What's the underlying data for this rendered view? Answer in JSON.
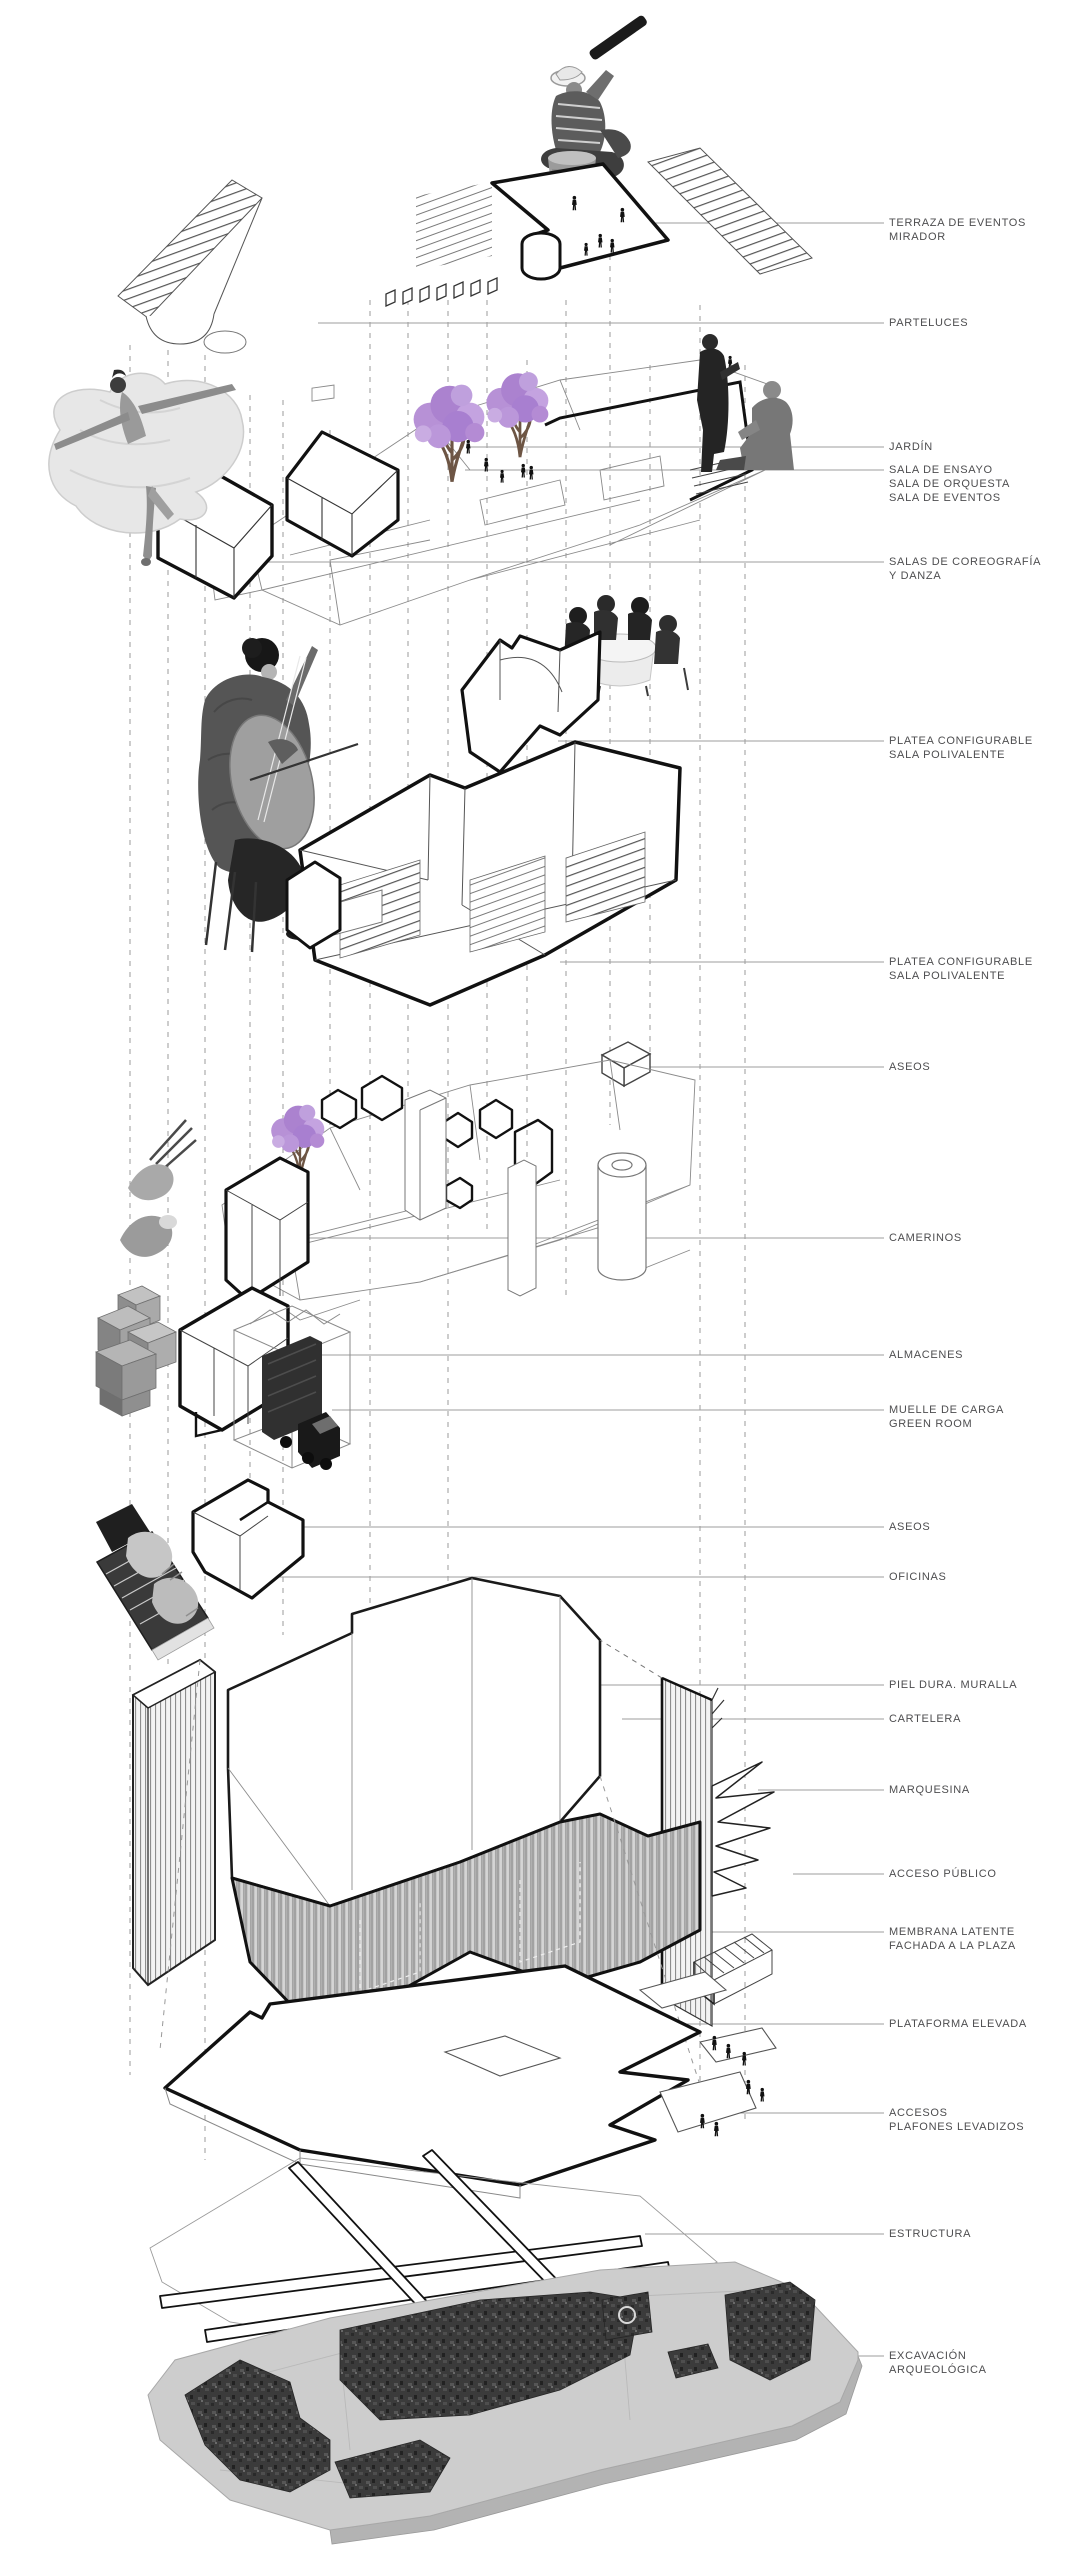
{
  "diagram": {
    "type": "exploded-axonometric-architectural-diagram",
    "language": "es"
  },
  "labels": [
    {
      "id": "terraza",
      "lines": [
        "TERRAZA DE EVENTOS",
        "MIRADOR"
      ]
    },
    {
      "id": "parteluces",
      "lines": [
        "PARTELUCES"
      ]
    },
    {
      "id": "jardin",
      "lines": [
        "JARDÍN"
      ]
    },
    {
      "id": "salas-ensayo",
      "lines": [
        "SALA DE ENSAYO",
        "SALA DE ORQUESTA",
        "SALA DE EVENTOS"
      ]
    },
    {
      "id": "coreografia",
      "lines": [
        "SALAS DE COREOGRAFÍA",
        "Y DANZA"
      ]
    },
    {
      "id": "platea-1",
      "lines": [
        "PLATEA CONFIGURABLE",
        "SALA POLIVALENTE"
      ]
    },
    {
      "id": "platea-2",
      "lines": [
        "PLATEA CONFIGURABLE",
        "SALA POLIVALENTE"
      ]
    },
    {
      "id": "aseos-1",
      "lines": [
        "ASEOS"
      ]
    },
    {
      "id": "camerinos",
      "lines": [
        "CAMERINOS"
      ]
    },
    {
      "id": "almacenes",
      "lines": [
        "ALMACENES"
      ]
    },
    {
      "id": "muelle",
      "lines": [
        "MUELLE DE CARGA",
        "GREEN ROOM"
      ]
    },
    {
      "id": "aseos-2",
      "lines": [
        "ASEOS"
      ]
    },
    {
      "id": "oficinas",
      "lines": [
        "OFICINAS"
      ]
    },
    {
      "id": "piel-dura",
      "lines": [
        "PIEL DURA. MURALLA"
      ]
    },
    {
      "id": "cartelera",
      "lines": [
        "CARTELERA"
      ]
    },
    {
      "id": "marquesina",
      "lines": [
        "MARQUESINA"
      ]
    },
    {
      "id": "acceso",
      "lines": [
        "ACCESO PÚBLICO"
      ]
    },
    {
      "id": "membrana",
      "lines": [
        "MEMBRANA LATENTE",
        "FACHADA A LA PLAZA"
      ]
    },
    {
      "id": "plataforma",
      "lines": [
        "PLATAFORMA ELEVADA"
      ]
    },
    {
      "id": "accesos",
      "lines": [
        "ACCESOS",
        "PLAFONES LEVADIZOS"
      ]
    },
    {
      "id": "estructura",
      "lines": [
        "ESTRUCTURA"
      ]
    },
    {
      "id": "excavacion",
      "lines": [
        "EXCAVACIÓN",
        "ARQUEOLÓGICA"
      ]
    }
  ],
  "figures": [
    "man-with-telescope-photo",
    "ballerina-photo",
    "jacaranda-trees",
    "conversation-men-photo",
    "meeting-table-photo",
    "cellist-photo",
    "makeup-hands-photo",
    "cardboard-boxes-photo",
    "truck-in-loading-dock",
    "typing-hands-photo",
    "people-silhouettes",
    "archaeological-excavation-plan"
  ],
  "colors": {
    "label_text": "#4d4d4f",
    "leader_line": "#9e9e9e",
    "bold_line": "#111111",
    "light_line": "#888888",
    "jacaranda_purple": "#ab82cf",
    "membrane_gray": "#bdbdbd",
    "excavation_plate": "#cdcdcd",
    "ruins_dark": "#3a3a3a"
  }
}
